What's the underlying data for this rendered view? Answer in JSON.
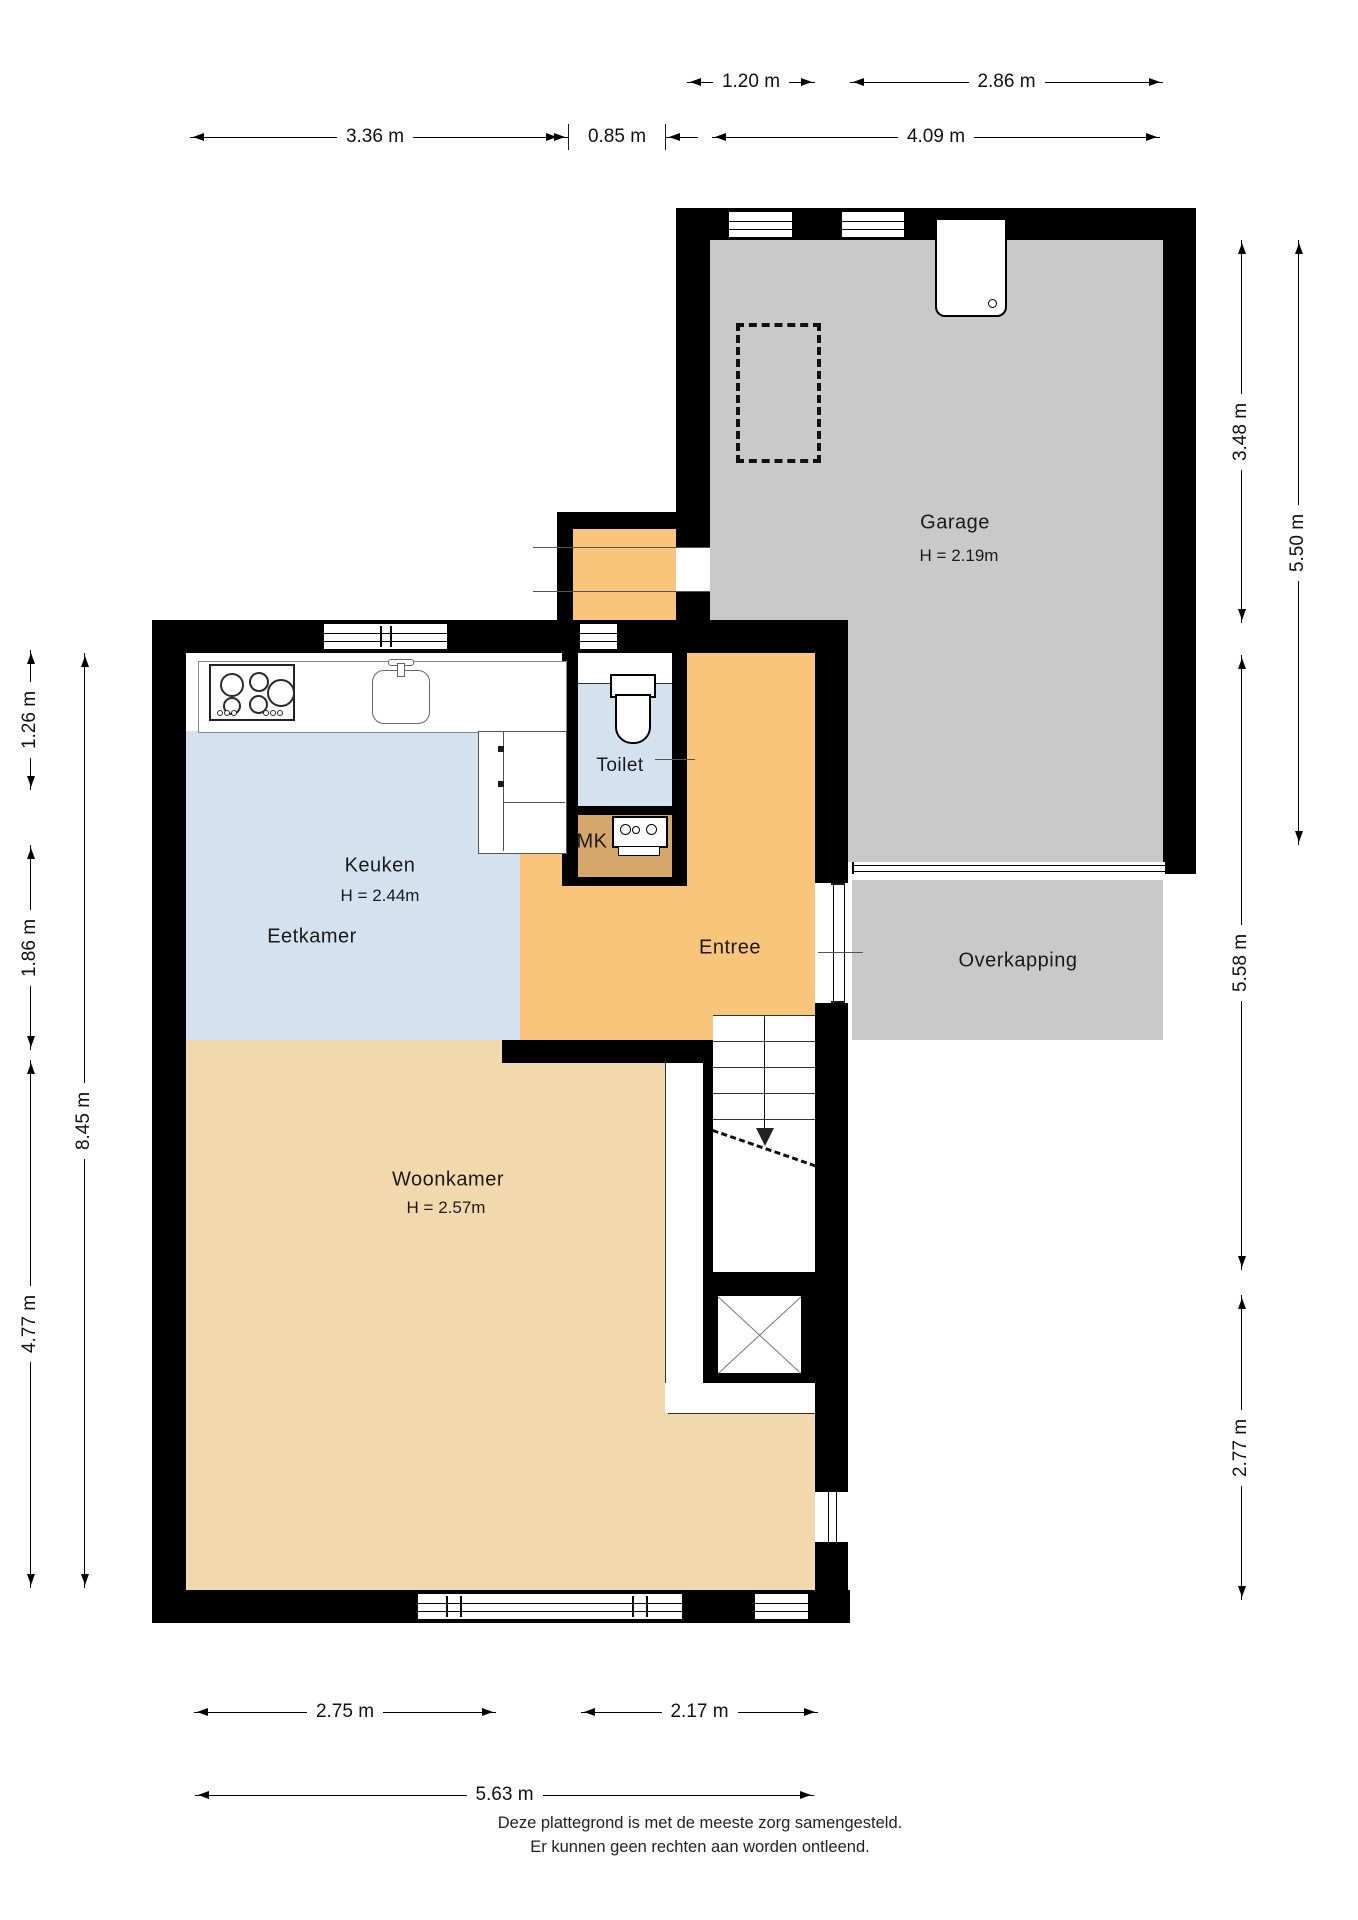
{
  "title": "Plattegrond begane grond",
  "colors": {
    "wall": "#000000",
    "garage": "#c9c9c9",
    "overkapping": "#c9c9c9",
    "dining": "#d4e1ef",
    "hall": "#f8c57a",
    "living": "#f2d9ad",
    "meter": "#d5a76b"
  },
  "rooms": {
    "garage": {
      "label": "Garage",
      "height": "H = 2.19m"
    },
    "toilet": {
      "label": "Toilet"
    },
    "keuken": {
      "label": "Keuken",
      "height": "H = 2.44m"
    },
    "eetkamer": {
      "label": "Eetkamer"
    },
    "mk": {
      "label": "MK"
    },
    "entree": {
      "label": "Entree"
    },
    "overkapping": {
      "label": "Overkapping"
    },
    "woonkamer": {
      "label": "Woonkamer",
      "height": "H = 2.57m"
    }
  },
  "dimensions": {
    "top": [
      {
        "label": "1.20 m"
      },
      {
        "label": "2.86 m"
      },
      {
        "label": "3.36 m"
      },
      {
        "label": "0.85 m"
      },
      {
        "label": "4.09 m"
      }
    ],
    "left": [
      {
        "label": "1.26 m"
      },
      {
        "label": "1.86 m"
      },
      {
        "label": "8.45 m"
      },
      {
        "label": "4.77 m"
      }
    ],
    "right": [
      {
        "label": "3.48 m"
      },
      {
        "label": "5.50 m"
      },
      {
        "label": "5.58 m"
      },
      {
        "label": "2.77 m"
      }
    ],
    "bottom": [
      {
        "label": "2.75 m"
      },
      {
        "label": "2.17 m"
      },
      {
        "label": "5.63 m"
      }
    ]
  },
  "footer": {
    "line1": "Deze plattegrond is met de meeste zorg samengesteld.",
    "line2": "Er kunnen geen rechten aan worden ontleend."
  }
}
